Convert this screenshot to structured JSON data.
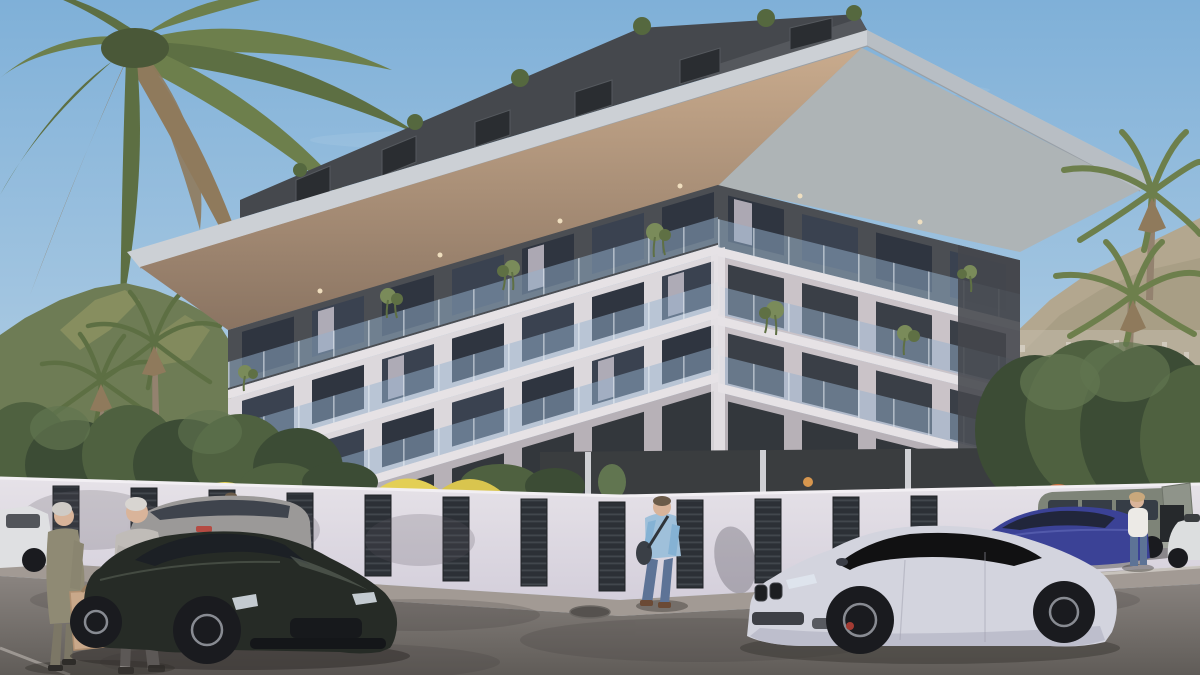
{
  "meta": {
    "type": "architectural-exterior-render",
    "setting": "modern residential apartment building on a street corner, clear day, mountains behind",
    "time_of_day": "daytime",
    "text_visible": "none"
  },
  "palette": {
    "sky-top": "#7fb0d8",
    "sky-mid": "#a9c9e2",
    "sky-low": "#d3dfe8",
    "cloud": "#ffffff",
    "mtn-left": "#6e7c55",
    "mtn-left-far": "#aaa88c",
    "mtn-left-lit": "#9fa06a",
    "mtn-right": "#b3a78f",
    "mtn-right-near": "#a3997f",
    "city": "#c3bbac",
    "city-dot": "#d8d2c6",
    "tree-dark": "#3c4c35",
    "tree-mid": "#4f6140",
    "tree-light": "#617550",
    "palm-green": "#5d6f43",
    "palm-green2": "#6d7f4c",
    "palm-dry": "#8f7a5c",
    "palm-trunk": "#93826f",
    "attic": "#45484d",
    "attic-panel": "#55585d",
    "dormer": "#2a2d31",
    "bush": "#55683f",
    "fascia": "#ccd0d5",
    "fascia-shade": "#b2b8bd",
    "soffit-wood1": "#c9ab8d",
    "soffit-wood2": "#8a7462",
    "soffit-metal": "#aeb4b6",
    "wall-dark": "#4b4e53",
    "wall-white": "#dcd8dc",
    "wall-white2": "#cac3c8",
    "wall-shade": "#b7b1b7",
    "slab": "#e6e2e5",
    "glass": "#2f3540",
    "glass2": "#3a4250",
    "glass-hi": "#7286a0",
    "balcony": "rgba(150,178,205,0.5)",
    "post": "#e8eef4",
    "curtain": "#cfc9d4",
    "plant": "#7a8b5a",
    "plant-dark": "#5f7044",
    "fence": "#e6e2e8",
    "fence-shade": "#d4cfdb",
    "slat": "#2c3036",
    "slat-line": "#585d63",
    "umbrella": "#e3cf55",
    "umbrella2": "#d9c54e",
    "awning-orange": "#c96f3f",
    "sidewalk": "#a29a94",
    "road1": "#8a8480",
    "road2": "#605c58",
    "road-shadow": "#3f3b3a",
    "road-line": "#d8d4cf",
    "porsche": "#262b26",
    "porsche-hi": "#6a7367",
    "bmw": "#d3d4de",
    "bmw-shade": "#b4b5c4",
    "blue-car": "#3b4296",
    "blue-car-hi": "#6a72c0",
    "suv": "#9b9998",
    "van": "#7e8478",
    "van2": "#8f948a",
    "white-car": "#dfe0e2",
    "scooter": "#dcdedf",
    "tire": "#1a1b1f",
    "rim": "#888b92",
    "taillight": "#b8433a",
    "headlight": "#dfe6ee",
    "caliper": "#a33b33",
    "lamp-warm": "#e8a050",
    "soffit-light": "#f2e2c2",
    "skin": "#d9b49a",
    "hair-white": "#d8d5d1",
    "hair-gray": "#cfcbc6",
    "hair-brown": "#6b5b49",
    "hair-blonde": "#c9a87c",
    "coat-olive": "#8f8a74",
    "coat-olive2": "#8a8570",
    "sweater": "#c0bcb8",
    "sweater2": "#b5b1ad",
    "shirt-blue": "#9fc0da",
    "shirt-blue2": "#85b2d4",
    "jeans": "#5d7396",
    "pants-gray": "#8b8784",
    "top-white": "#eceae6",
    "bag-tan": "#c9a88a",
    "bag-tan2": "#b08f70",
    "shadow": "#2f2c29"
  },
  "scene": {
    "building": {
      "floors_visible": 4,
      "attic": "set-back penthouse level with slanted dark metal roof, dormer windows and round green shrubs",
      "roof": "wide cantilevered flat roof slab, light gray fascia, wood soffit underneath, recessed spotlights",
      "left_facade": "white concrete grid, dark top floor, glass balustrade balconies, hanging plants, 7 window bays",
      "right_facade": "deep concrete loggias with glass railings, dark-clad far end, 4 bays",
      "ground_level": "dark glazed storefront behind perimeter fence, warm wall lamp"
    },
    "fence": "white perimeter wall with evenly spaced dark horizontal-louver gate panels",
    "umbrellas": {
      "yellow_count": 4,
      "orange_count": 1,
      "location": "courtyard behind fence"
    },
    "vehicles": [
      {
        "name": "porsche-panamera",
        "color": "dark green-black",
        "position": "foreground left",
        "facing": "front-right three-quarter"
      },
      {
        "name": "bmw-m5",
        "color": "silver-white",
        "position": "foreground right",
        "facing": "front-left three-quarter"
      },
      {
        "name": "blue-sedan",
        "color": "indigo blue",
        "position": "parked behind BMW"
      },
      {
        "name": "camper-van",
        "color": "sage gray-green",
        "position": "far right, tailgate open"
      },
      {
        "name": "scooter",
        "color": "white",
        "position": "far right edge, partially cropped"
      },
      {
        "name": "gray-suv",
        "color": "gray",
        "position": "middle left, parked by fence"
      },
      {
        "name": "white-car",
        "color": "white",
        "position": "far left edge, partially cropped"
      }
    ],
    "people": [
      {
        "name": "elderly-couple",
        "detail": "man in gray sweater with white hair, woman in olive coat, tan paper shopping bag",
        "position": "bottom left, walking right"
      },
      {
        "name": "cyclist",
        "detail": "man in light blue shirt riding bicycle",
        "position": "left, mostly hidden behind gray SUV"
      },
      {
        "name": "man-at-gate",
        "detail": "man in light blue shirt, dark jeans, shoulder bag",
        "position": "center, standing at fence gate"
      },
      {
        "name": "woman-standing",
        "detail": "woman in white top and blue jeans",
        "position": "right, beside parked cars"
      }
    ],
    "landscape": {
      "left": "forested green mountain, row of trees, two slender palms",
      "right": "hazy brown mountain with distant hillside town, dense dark trees, two tall palms",
      "top_left": "large palm fronds overhanging the frame"
    }
  }
}
